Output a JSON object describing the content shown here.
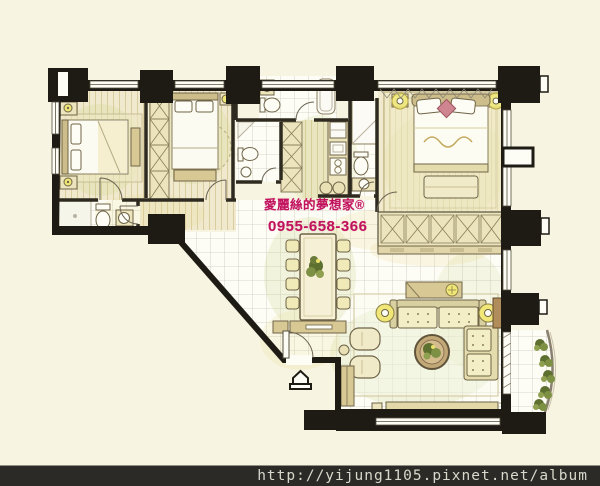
{
  "canvas": {
    "width": 600,
    "height": 486,
    "background": "#f7f4e1"
  },
  "watermark": {
    "brand": "愛麗絲的夢想家®",
    "phone": "0955-658-366",
    "color": "#c2125e"
  },
  "footer": {
    "url": "http://yijung1105.pixnet.net/album",
    "background": "#2b2a26",
    "text_color": "#d8d8cc"
  },
  "palette": {
    "wall_black": "#1e1b15",
    "wood_floor": "#f1ead0",
    "tile_floor": "#fdfdf6",
    "furniture_fill": "#ece4bc",
    "furniture_border": "#6f6447",
    "accent_yellow": "#f0e778",
    "cushion_pink": "#cf8590",
    "plant_green": "#5e7030",
    "wash_green": "#c8d07e"
  },
  "icons": {
    "entry_marker": "house-arrow"
  }
}
